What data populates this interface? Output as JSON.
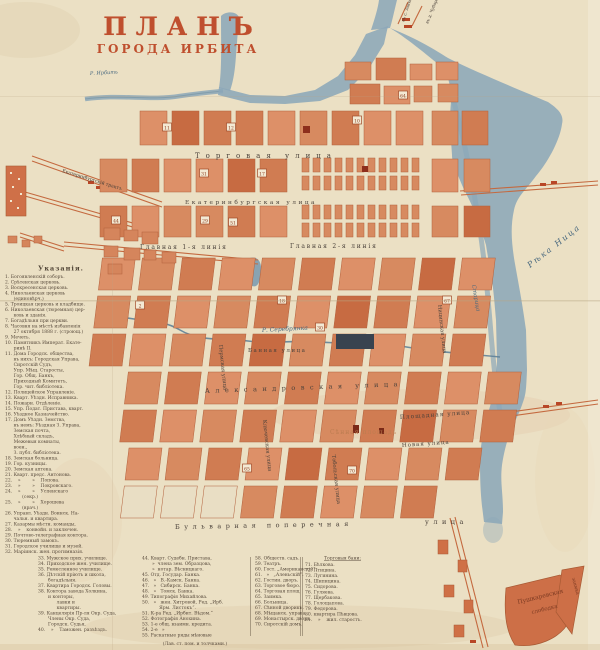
{
  "title": {
    "line1": "ПЛАНЪ",
    "line2": "ГОРОДА ИРБИТА"
  },
  "map": {
    "labels": {
      "river_irbit": "Р. Ирбить",
      "river_nitsa": "Рѣка Ница",
      "river_serebryanka": "Р. Серебрянка",
      "staritsa": "Старица",
      "torgovaya": "Торговая улица",
      "ekaterinburgskaya": "Екатеринбургская улица",
      "glavnaya1": "Главная 1-я линія",
      "glavnaya2": "Главная 2-я линія",
      "bannaya": "Банная улица",
      "alexandrovskaya": "Александровская улица",
      "ploschadnaya": "Площадная улица",
      "novaya": "Новая улица",
      "sennaya": "Сѣнная площадь",
      "bulvarnaya": "Бульварная поперечная",
      "bulvarnaya_ulitsa": "улица",
      "permskaya": "Пермская улица",
      "klyuchevskaya": "Ключевская улица",
      "nitsinskaya": "Ницинская улица",
      "tobolskaya": "Тобольская улица",
      "trakt": "Екатеринбургскій трактъ",
      "road_ne1": "въ с. Зайково",
      "road_ne2": "въ д. Чубарову",
      "sloboda_line1": "Пушкаревская",
      "sloboda_line2": "слободка",
      "zaimka": "заимка"
    },
    "markers": [
      {
        "n": "11",
        "x": 167,
        "y": 127
      },
      {
        "n": "12",
        "x": 231,
        "y": 127
      },
      {
        "n": "10",
        "x": 357,
        "y": 120
      },
      {
        "n": "64",
        "x": 403,
        "y": 95
      },
      {
        "n": "31",
        "x": 204,
        "y": 173
      },
      {
        "n": "17",
        "x": 262,
        "y": 173
      },
      {
        "n": "29",
        "x": 205,
        "y": 220
      },
      {
        "n": "44",
        "x": 116,
        "y": 220
      },
      {
        "n": "51",
        "x": 233,
        "y": 222
      },
      {
        "n": "30",
        "x": 320,
        "y": 327
      },
      {
        "n": "18",
        "x": 282,
        "y": 300
      },
      {
        "n": "67",
        "x": 447,
        "y": 300
      },
      {
        "n": "70",
        "x": 352,
        "y": 470
      },
      {
        "n": "65",
        "x": 247,
        "y": 468
      },
      {
        "n": "2",
        "x": 140,
        "y": 305
      }
    ]
  },
  "legend_left": {
    "heading": "Указанія.",
    "items": [
      "1. Богоявленскій соборъ.",
      "2. Срѣтенская церковь.",
      "3. Воскресенская церковь.",
      "4. Николаевская церковь",
      "      (единовѣрч.)",
      "5. Троицкая церковь и кладбище.",
      "6. Николаевская (тюремная) цер-",
      "      ковь и зданія.",
      "7. Богадѣльня при церкви.",
      "8. Часовня на мѣстѣ избавленія",
      "      27 октября 1888 г. (строющ.)",
      "9. Мечеть.",
      "10. Памятникъ Императ. Екате-",
      "      ринѣ II.",
      "11. Дома Городск. общества,",
      "      въ нихъ: Городская Управа,",
      "      Сиротскій Судъ,",
      "      Упр. Мѣщ. Старосты,",
      "      Гор. Общ. Банкъ,",
      "      Приходный Комитетъ,",
      "      Гор. чит. библіотека.",
      "12. Полицейское Управленіе.",
      "13. Кварт. Уѣздн. Исправника.",
      "14. Пожарн. Отдѣленіе.",
      "15. Упр. Подат. Пристава, кварт.",
      "16. Уѣздное Казначейство.",
      "17. Домъ Уѣздн. Земства,",
      "      въ немъ: Уѣздная З. Управа,",
      "      Земская почта,",
      "      Хлѣбный складъ,",
      "      Межевыя комнаты,",
      "      воен.,",
      "      З. публ. библіотека.",
      "18. Земская больница.",
      "19. Гор. кузницы.",
      "20. Земская аптека.",
      "21. Кварт. предс. Антонова.",
      "22.    »        »    Попова.",
      "23.    »        »    Покровскаго.",
      "24.    »        »    Успенскаго",
      "            (секр.)",
      "25.    »        »    Хорошева",
      "            (врач.)",
      "26. Управл. Уѣздн. Воинск. На-",
      "      чальн. и квартира.",
      "27. Казармы мѣстн. команды,",
      "28.    »    конвойн. и заключен.",
      "29. Почтово-телеграфная контора.",
      "30. Тюремный замокъ.",
      "31. Городское училище и музей.",
      "32. Маріинск. жен. прогимназія."
    ]
  },
  "legend_bottom": {
    "col1": [
      "33. Мужское прих. училище.",
      "34. Приходское жен. училище.",
      "35. Ремесленное училище.",
      "36. Дѣтскій пріютъ и школа,",
      "       богадѣльня.",
      "37. Квартира Городск. Головы.",
      "38. Контора завода Холкина,",
      "       и конторы,",
      "             лавки и",
      "             квартиры.",
      "39. Канцелярія Пр-ля Окр. Суда,",
      "       Члены Окр. Суда,",
      "       Городск. Судья,",
      "40.    »    Таможен. разъѣздъ."
    ],
    "col2": [
      "44. Кварт. Судебн. Пристава,",
      "       »  члена зем. Образцова,",
      "       »  нотар. Вѣсницкаго.",
      "45. Отд. Государ. Банка.",
      "46.   »   В.-Камск. Банка.",
      "47.   »   Сибирск. Банка.",
      "48.   »   Томск. Банка.",
      "49. Типографія Михайлова.",
      "50.   »   жен. Хитровой, Ред. „Ирб.",
      "            Ярм. Листокъ“.",
      "51. К-ра Ред. „Ирбит. Вѣдом.“",
      "52. Фотографія Анохина.",
      "53. 1-е общ. взаимн. кредита.",
      "54. 2-е   »",
      "55. Раскатные ряды мѣновые"
    ],
    "col2_note": "(Лав. ст. пом. и толчками.)",
    "col3": [
      "58. Обществ. садъ.",
      "59. Театръ.",
      "60. Гост. „Американскій“.",
      "61.   »   „Аленьскій“.",
      "62. Гостин. дворъ.",
      "63. Торговое бюро.",
      "64. Торговая площ.",
      "65. Заимка.",
      "66. Больница.",
      "67. Сѣнной дворикъ.",
      "68. Мѣщанск. управа.",
      "69. Монастырск. дворъ.",
      "70. Сиротскій домъ."
    ],
    "col4_header": "Торговыя бани:",
    "col4": [
      "71. Бѣлкова.",
      "72. Птицина.",
      "73. Лугинина.",
      "74. Шипицина.",
      "75. Сидорова.",
      "76. Гуляева.",
      "77. Щербакова.",
      "78. Голощапова.",
      "79. Федорова.",
      "80. квартира Пѣвцова.",
      "81.    »    жил. старостъ."
    ]
  }
}
